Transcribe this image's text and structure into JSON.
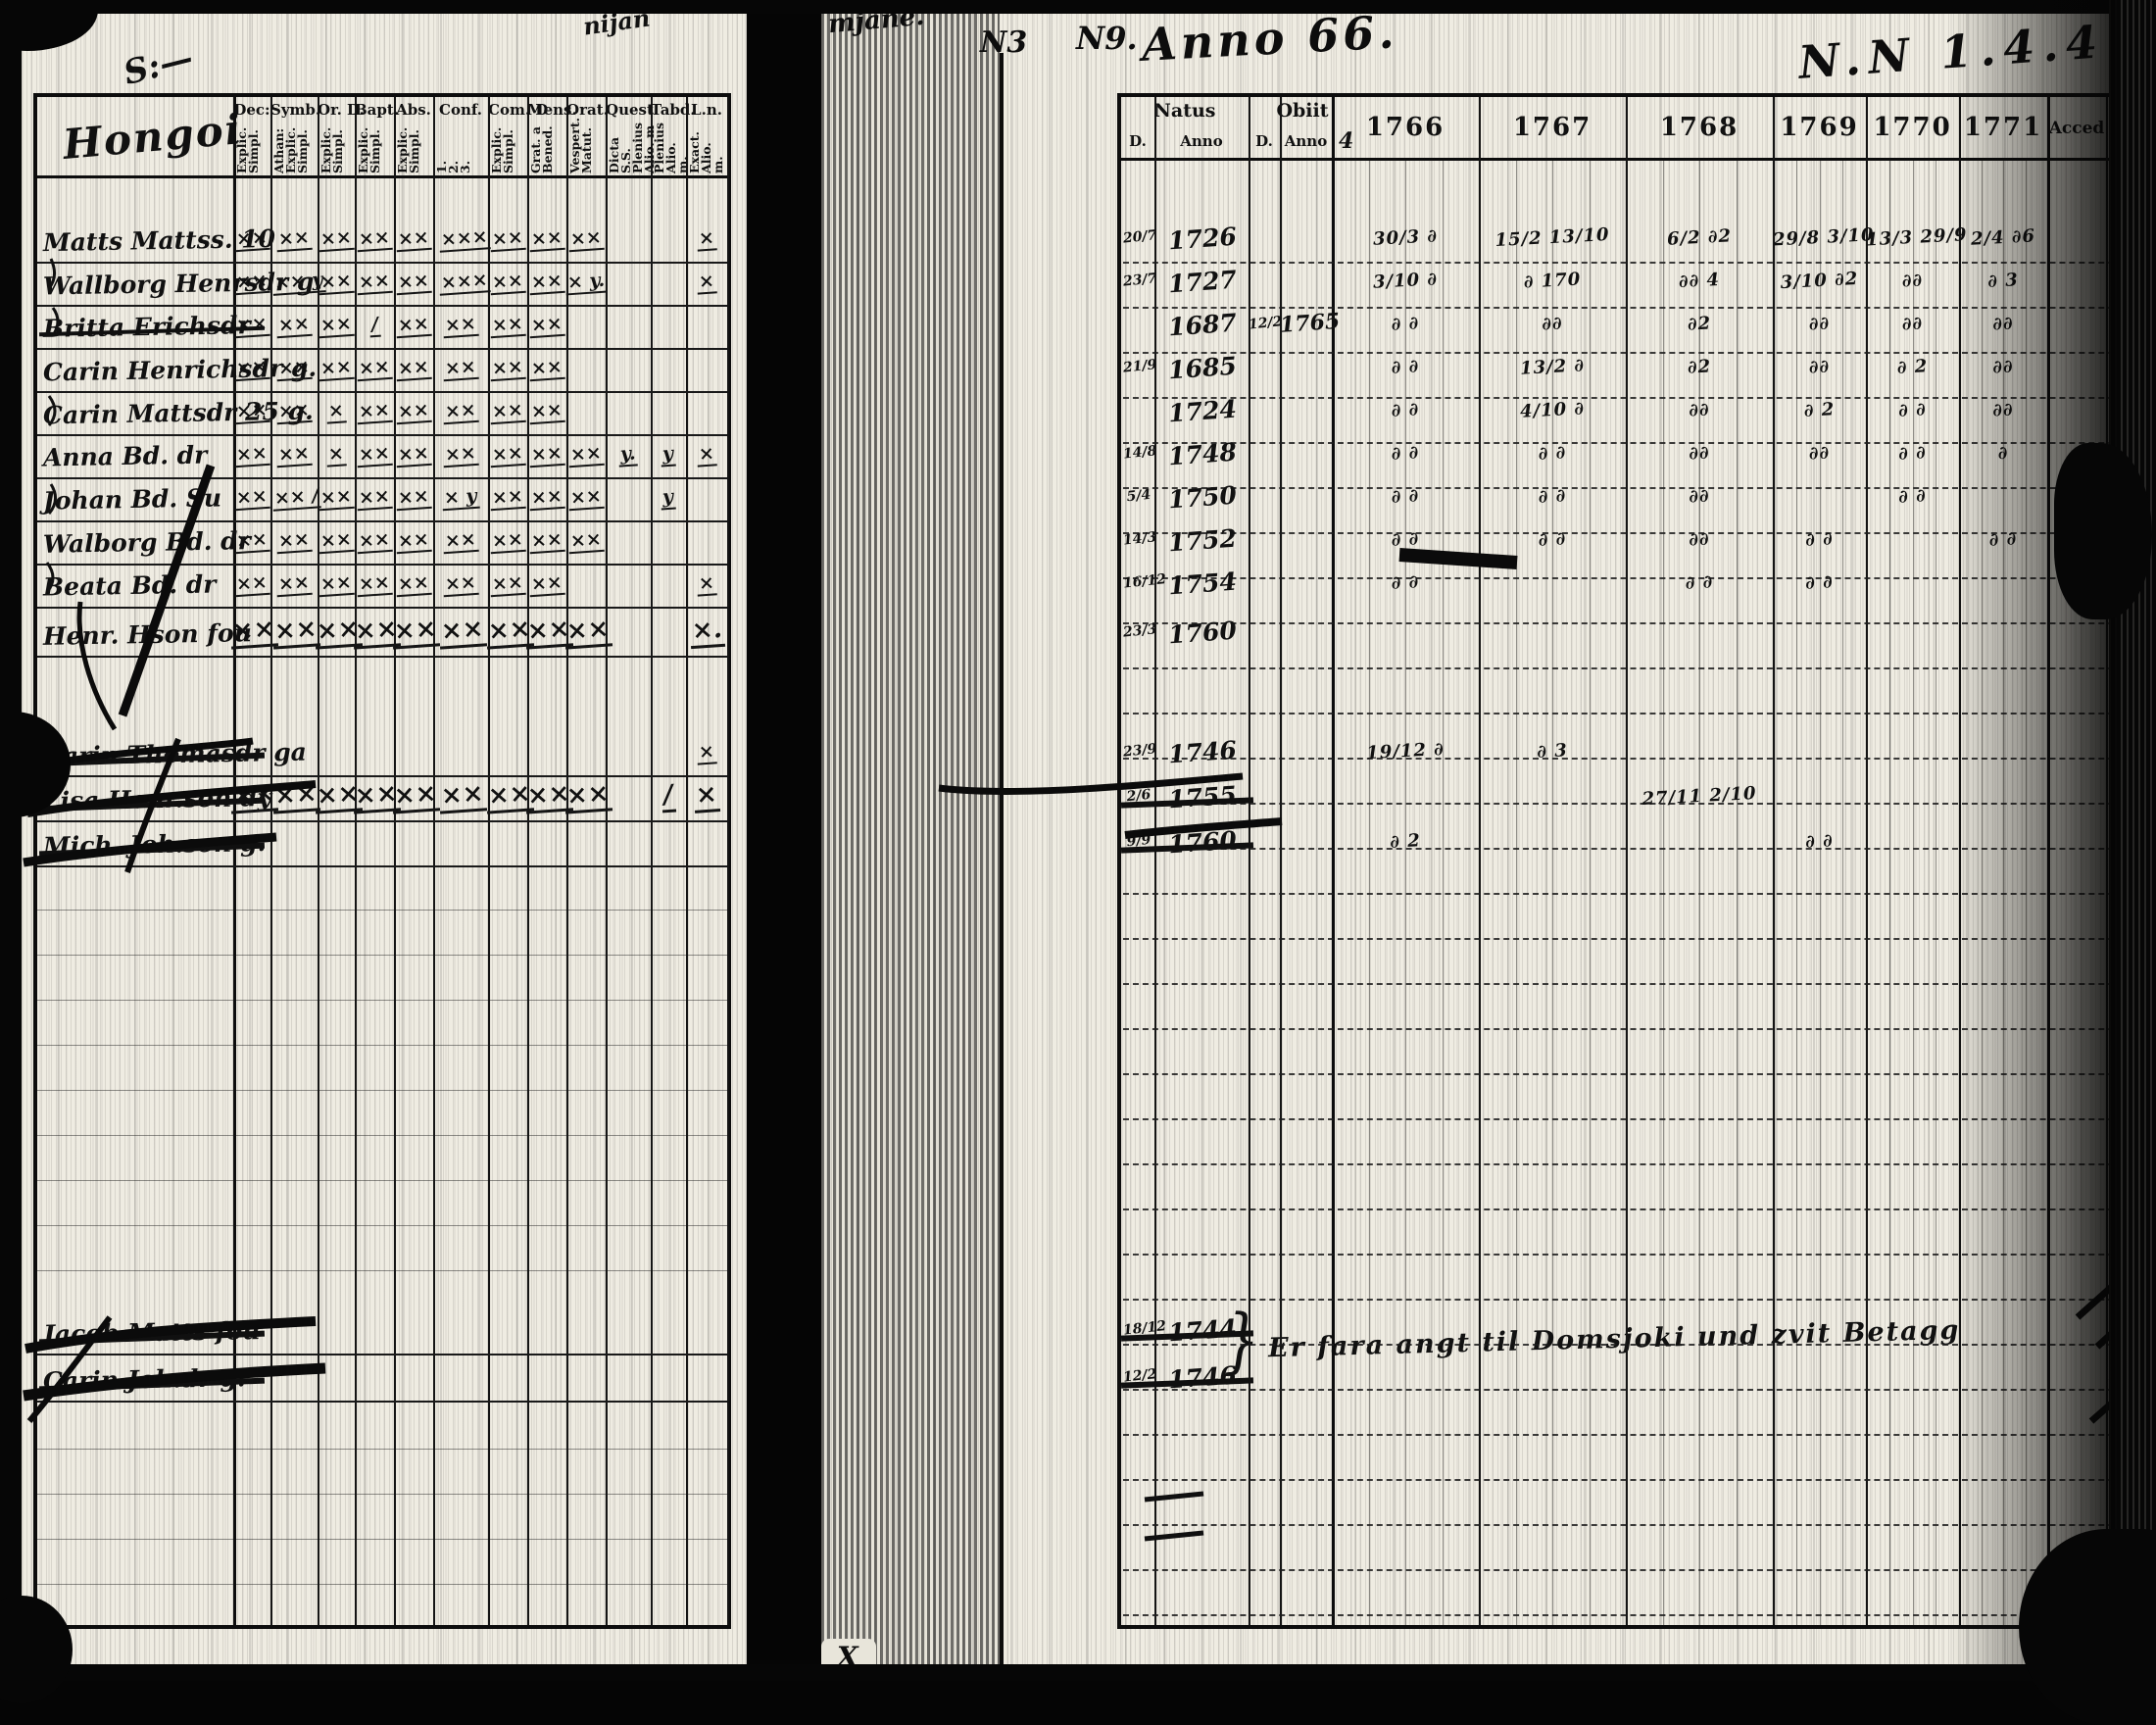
{
  "marginalia": {
    "top_scribble_1": "nijan",
    "top_scribble_2": "mjane.",
    "no_left": "N3",
    "no_right": "N9.",
    "anno_scrawl": "Anno 66.",
    "right_scrawl": "N.N 1.4.4",
    "header_sub_extra": "4",
    "bottom_center_mark": "X"
  },
  "left_page": {
    "place_name": "Hongoi",
    "columns": [
      {
        "label": "Dec:",
        "sub": "Explic.\nSimpl."
      },
      {
        "label": "Symb.",
        "sub": "Athan:\nExplic.\nSimpl."
      },
      {
        "label": "Or. D.",
        "sub": "Explic.\nSimpl."
      },
      {
        "label": "Bapt.",
        "sub": "Explic.\nSimpl."
      },
      {
        "label": "Abs.",
        "sub": "Explic.\nSimpl."
      },
      {
        "label": "Conf.",
        "sub": "1.\n2.\n3."
      },
      {
        "label": "Com. D",
        "sub": "Explic.\nSimpl."
      },
      {
        "label": "Mens.",
        "sub": "Grat. a\nBened."
      },
      {
        "label": "Orat.",
        "sub": "Vespert.\nMatut."
      },
      {
        "label": "Quest.",
        "sub": "Dicta S.S.\nPlenius\nAlio. m"
      },
      {
        "label": "Tabd.",
        "sub": "Plenius\nAlio. m."
      },
      {
        "label": "L.n.",
        "sub": "Exact.\nAlio. m."
      }
    ],
    "rows": [
      {
        "name": "Matts Mattss. 10",
        "struck": false,
        "big": false,
        "marks": [
          "××",
          "××",
          "××",
          "××",
          "××",
          "×××",
          "××",
          "××",
          "××",
          "",
          "",
          "×"
        ]
      },
      {
        "name": "Wallborg Henrsdr g.",
        "struck": false,
        "big": false,
        "marks": [
          "××",
          "×× y",
          "××",
          "××",
          "××",
          "×××",
          "××",
          "××",
          "× y.",
          "",
          "",
          "×"
        ]
      },
      {
        "name": "Britta Erichsdr",
        "struck": true,
        "big": false,
        "marks": [
          "××",
          "××",
          "××",
          "/",
          "××",
          "××",
          "××",
          "××",
          "",
          "",
          "",
          ""
        ]
      },
      {
        "name": "Carin Henrichsdr g.",
        "struck": false,
        "big": false,
        "marks": [
          "××",
          "××",
          "××",
          "××",
          "××",
          "××",
          "××",
          "××",
          "",
          "",
          "",
          ""
        ]
      },
      {
        "name": "Carin Mattsdr 25 g.",
        "struck": false,
        "big": false,
        "marks": [
          "××",
          "××",
          "×",
          "××",
          "××",
          "××",
          "××",
          "××",
          "",
          "",
          "",
          ""
        ]
      },
      {
        "name": "Anna Bd. dr",
        "struck": false,
        "big": false,
        "marks": [
          "××",
          "××",
          "×",
          "××",
          "××",
          "××",
          "××",
          "××",
          "××",
          "y.",
          "y",
          "×"
        ]
      },
      {
        "name": "Johan Bd. Su",
        "struck": false,
        "big": false,
        "marks": [
          "××",
          "×× /",
          "××",
          "××",
          "××",
          "× y",
          "××",
          "××",
          "××",
          "",
          "y",
          ""
        ]
      },
      {
        "name": "Walborg Bd. dr",
        "struck": false,
        "big": false,
        "marks": [
          "××",
          "××",
          "××",
          "××",
          "××",
          "××",
          "××",
          "××",
          "××",
          "",
          "",
          ""
        ]
      },
      {
        "name": "Beata Bd. dr",
        "struck": false,
        "big": false,
        "marks": [
          "××",
          "××",
          "××",
          "××",
          "××",
          "××",
          "××",
          "××",
          "",
          "",
          "",
          "×"
        ]
      },
      {
        "name": "Henr. Hson fou",
        "struck": false,
        "big": true,
        "marks": [
          "××",
          "××",
          "××",
          "××",
          "××",
          "××",
          "××",
          "××",
          "××",
          "",
          "",
          "×."
        ]
      },
      {
        "name": "Carin Thomasdr ga",
        "struck": true,
        "big": false,
        "marks": [
          "",
          "",
          "",
          "",
          "",
          "",
          "",
          "",
          "",
          "",
          "",
          "×"
        ]
      },
      {
        "name": "Lisa Henr.son dy",
        "struck": true,
        "big": true,
        "marks": [
          "××",
          "××",
          "××",
          "××",
          "××",
          "××",
          "××",
          "××",
          "××",
          "",
          "/",
          "×"
        ]
      },
      {
        "name": "Mich. Joh.son g.",
        "struck": true,
        "big": false,
        "marks": [
          "",
          "",
          "",
          "",
          "",
          "",
          "",
          "",
          "",
          "",
          "",
          ""
        ]
      },
      {
        "name": "Jacob Matts fou",
        "struck": true,
        "big": false,
        "marks": [
          "",
          "",
          "",
          "",
          "",
          "",
          "",
          "",
          "",
          "",
          "",
          ""
        ]
      },
      {
        "name": "Carin Joh.dr g.",
        "struck": true,
        "big": false,
        "marks": [
          "",
          "",
          "",
          "",
          "",
          "",
          "",
          "",
          "",
          "",
          "",
          ""
        ]
      }
    ]
  },
  "right_page": {
    "header": {
      "natus": "Natus",
      "obiit": "Obiit",
      "d1": "D.",
      "anno1": "Anno",
      "d2": "D.",
      "anno2": "Anno",
      "years": [
        "1766",
        "1767",
        "1768",
        "1769",
        "1770",
        "1771"
      ],
      "acced": "Acced",
      "abit": "Abit"
    },
    "rows": [
      {
        "natus_d": "20/7",
        "natus_anno": "1726",
        "obiit_d": "",
        "obiit_anno": "",
        "struck": false,
        "years": [
          "30/3 ∂",
          "15/2 13/10",
          "6/2 ∂2",
          "29/8 3/10",
          "13/3 29/9",
          "2/4 ∂6"
        ]
      },
      {
        "natus_d": "23/7",
        "natus_anno": "1727",
        "obiit_d": "",
        "obiit_anno": "",
        "struck": false,
        "years": [
          "3/10 ∂",
          "∂ 170",
          "∂∂ 4",
          "3/10 ∂2",
          "∂∂",
          "∂ 3"
        ]
      },
      {
        "natus_d": "",
        "natus_anno": "1687",
        "obiit_d": "12/2",
        "obiit_anno": "1765",
        "struck": false,
        "years": [
          "∂ ∂",
          "∂∂",
          "∂2",
          "∂∂",
          "∂∂",
          "∂∂"
        ]
      },
      {
        "natus_d": "21/9",
        "natus_anno": "1685",
        "obiit_d": "",
        "obiit_anno": "",
        "struck": false,
        "years": [
          "∂ ∂",
          "13/2 ∂",
          "∂2",
          "∂∂",
          "∂ 2",
          "∂∂"
        ]
      },
      {
        "natus_d": "",
        "natus_anno": "1724",
        "obiit_d": "",
        "obiit_anno": "",
        "struck": false,
        "years": [
          "∂ ∂",
          "4/10 ∂",
          "∂∂",
          "∂ 2",
          "∂ ∂",
          "∂∂"
        ]
      },
      {
        "natus_d": "14/8",
        "natus_anno": "1748",
        "obiit_d": "",
        "obiit_anno": "",
        "struck": false,
        "years": [
          "∂ ∂",
          "∂ ∂",
          "∂∂",
          "∂∂",
          "∂ ∂",
          "∂"
        ]
      },
      {
        "natus_d": "5/4",
        "natus_anno": "1750",
        "obiit_d": "",
        "obiit_anno": "",
        "struck": false,
        "years": [
          "∂ ∂",
          "∂ ∂",
          "∂∂",
          "",
          "∂ ∂",
          ""
        ]
      },
      {
        "natus_d": "14/3",
        "natus_anno": "1752",
        "obiit_d": "",
        "obiit_anno": "",
        "struck": false,
        "years": [
          "∂ ∂",
          "∂ ∂",
          "∂∂",
          "∂ ∂",
          "",
          "∂ ∂"
        ]
      },
      {
        "natus_d": "16/12",
        "natus_anno": "1754",
        "obiit_d": "",
        "obiit_anno": "",
        "struck": false,
        "years": [
          "∂ ∂",
          "",
          "∂ ∂",
          "∂ ∂",
          "",
          ""
        ]
      },
      {
        "natus_d": "23/3",
        "natus_anno": "1760",
        "obiit_d": "",
        "obiit_anno": "",
        "struck": false,
        "years": [
          "",
          "",
          "",
          "",
          "",
          ""
        ]
      },
      {
        "natus_d": "23/9",
        "natus_anno": "1746",
        "obiit_d": "",
        "obiit_anno": "",
        "struck": false,
        "years": [
          "19/12 ∂",
          "∂ 3",
          "",
          "",
          "",
          ""
        ]
      },
      {
        "natus_d": "2/6",
        "natus_anno": "1755",
        "obiit_d": "",
        "obiit_anno": "",
        "struck": true,
        "years": [
          "",
          "",
          "27/11 2/10",
          "",
          "",
          ""
        ]
      },
      {
        "natus_d": "9/9",
        "natus_anno": "1760",
        "obiit_d": "",
        "obiit_anno": "",
        "struck": true,
        "years": [
          "∂ 2",
          "",
          "",
          "∂ ∂",
          "",
          ""
        ]
      },
      {
        "natus_d": "18/12",
        "natus_anno": "1744",
        "obiit_d": "",
        "obiit_anno": "",
        "struck": true,
        "years": [
          "",
          "",
          "",
          "",
          "",
          ""
        ]
      },
      {
        "natus_d": "12/2",
        "natus_anno": "1746",
        "obiit_d": "",
        "obiit_anno": "",
        "struck": true,
        "years": [
          "",
          "",
          "",
          "",
          "",
          ""
        ]
      }
    ],
    "bottom_note": {
      "brace": "}",
      "text": "Er fara angt til Domsjoki und zvit Betagg"
    }
  }
}
